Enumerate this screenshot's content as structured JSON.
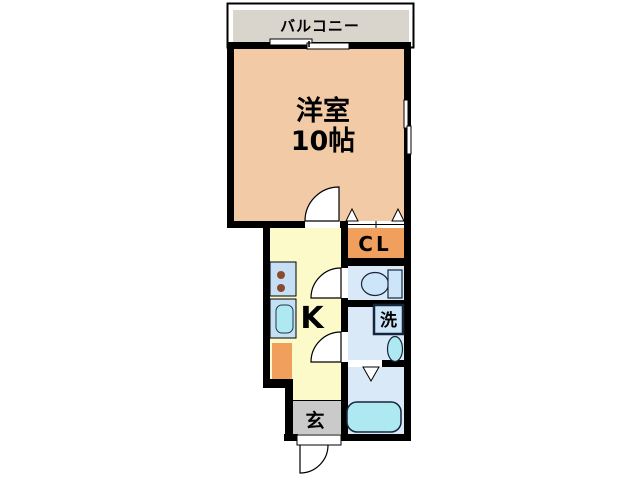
{
  "floorplan": {
    "balcony_label": "バルコニー",
    "main_room_label": "洋室",
    "main_room_size": "10帖",
    "closet_label": "CL",
    "kitchen_label": "K",
    "washer_label": "洗",
    "entrance_label": "玄"
  },
  "colors": {
    "wall": "#000000",
    "balcony_gray": "#D9D5CD",
    "main_room_peach": "#F2CBA6",
    "kitchen_yellow": "#FCFAC8",
    "closet_orange": "#F0A05C",
    "wet_room_blue": "#D9E9F8",
    "counter_blue": "#C5DFF5",
    "fixture_cyan": "#AEE9F2",
    "fixture_blue": "#CDE5F8",
    "entrance_gray": "#CACACA",
    "burner_brown": "#8B4A2F"
  }
}
